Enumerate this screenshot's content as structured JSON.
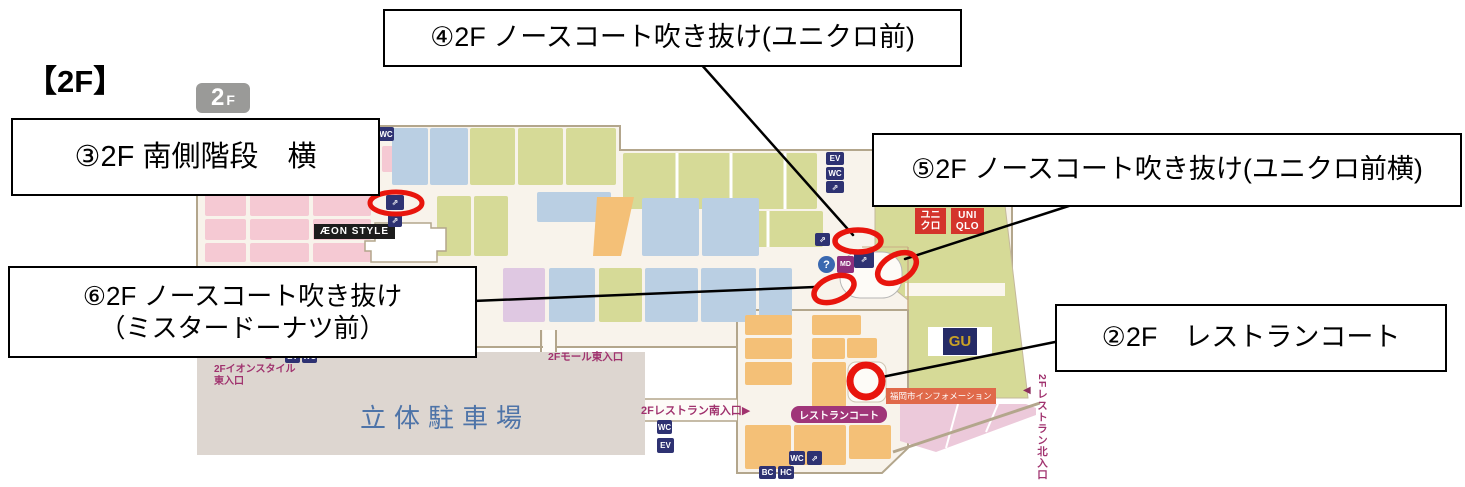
{
  "title": "【2F】",
  "floor_badge": {
    "number": "2",
    "letter": "F"
  },
  "callouts": {
    "no2": "②2F　レストランコート",
    "no3": "③2F 南側階段　横",
    "no4": "④2F ノースコート吹き抜け(ユニクロ前)",
    "no5": "⑤2F ノースコート吹き抜け(ユニクロ前横)",
    "no6_line1": "⑥2F ノースコート吹き抜け",
    "no6_line2": "（ミスタードーナツ前）"
  },
  "map": {
    "store_labels": {
      "aeon_style": "ÆON STYLE",
      "uniqlo_jp_line1": "ユニ",
      "uniqlo_jp_line2": "クロ",
      "uniqlo_en_line1": "UNI",
      "uniqlo_en_line2": "QLO",
      "gu": "GU"
    },
    "area_labels": {
      "parking": "立体駐車場",
      "restaurant_court": "レストランコート",
      "city_information": "福岡市インフォメーション"
    },
    "entrance_labels": {
      "mall_east": "2Fモール東入口",
      "aeon_style_east_line1": "2Fイオンスタイル",
      "aeon_style_east_line2": "東入口",
      "restaurant_south": "2Fレストラン南入口",
      "restaurant_north": "2Fレストラン北入口"
    },
    "icons": {
      "restroom": "WC",
      "elevator": "EV",
      "escalator": "⇗",
      "information": "?",
      "mister_donut": "MD",
      "baby_room": "BC",
      "wheelchair": "HC",
      "triangle_up": "▲",
      "triangle_right": "▶",
      "triangle_left": "◀"
    }
  },
  "colors": {
    "marker_red": "#e8150d",
    "leader_line": "#000000",
    "floor_beige": "#f8f3eb",
    "wall_tan": "#b3a68c",
    "block_pink": "#f5c9d3",
    "block_blue": "#bacfe3",
    "block_green": "#d6da97",
    "block_orange": "#f4c077",
    "block_lavender": "#dfc8e2",
    "parking_gray": "#ddd6d0",
    "icon_navy": "#2e3272",
    "label_purple": "#a0326e",
    "uniqlo_red": "#d4342c",
    "gu_navy": "#252b66",
    "gu_gold": "#c8a126",
    "info_badge_orange": "#e0694a",
    "court_badge_purple": "#a03579"
  }
}
